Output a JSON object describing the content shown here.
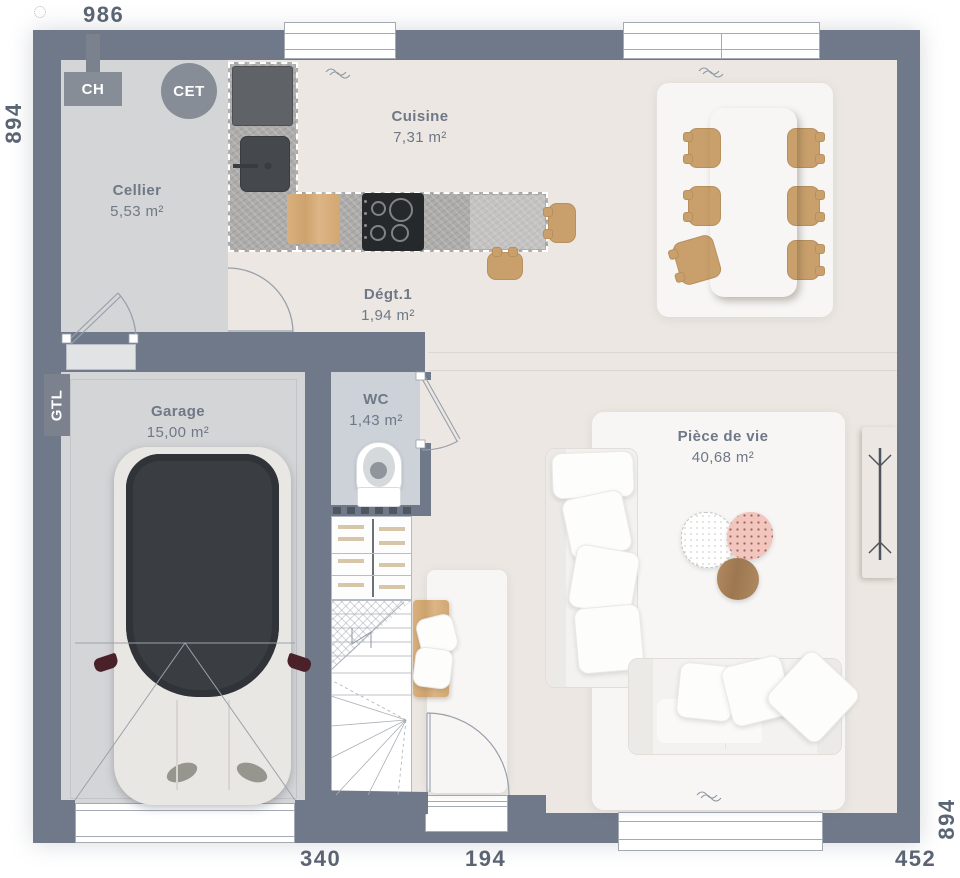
{
  "plan": {
    "title": "floor-plan",
    "dimensions": {
      "top": "986",
      "left": "894",
      "right": "894",
      "bottom_garage": "340",
      "bottom_entry": "194",
      "bottom_living": "452"
    },
    "rooms": [
      {
        "name": "Cellier",
        "area": "5,53 m²"
      },
      {
        "name": "Cuisine",
        "area": "7,31 m²"
      },
      {
        "name": "Dégt.1",
        "area": "1,94 m²"
      },
      {
        "name": "Garage",
        "area": "15,00 m²"
      },
      {
        "name": "WC",
        "area": "1,43 m²"
      },
      {
        "name": "Pièce de vie",
        "area": "40,68 m²"
      }
    ],
    "equipment": {
      "ch": "CH",
      "cet": "CET",
      "gtl": "GTL"
    },
    "colors": {
      "wall": "#6f7989",
      "floor_service": "#d4d5d7",
      "floor_main": "#ece7e2",
      "floor_wc": "#ccd2d7",
      "wood": "#d2a877",
      "label_text": "#6f7887",
      "dimension_text": "#5a6473"
    }
  }
}
